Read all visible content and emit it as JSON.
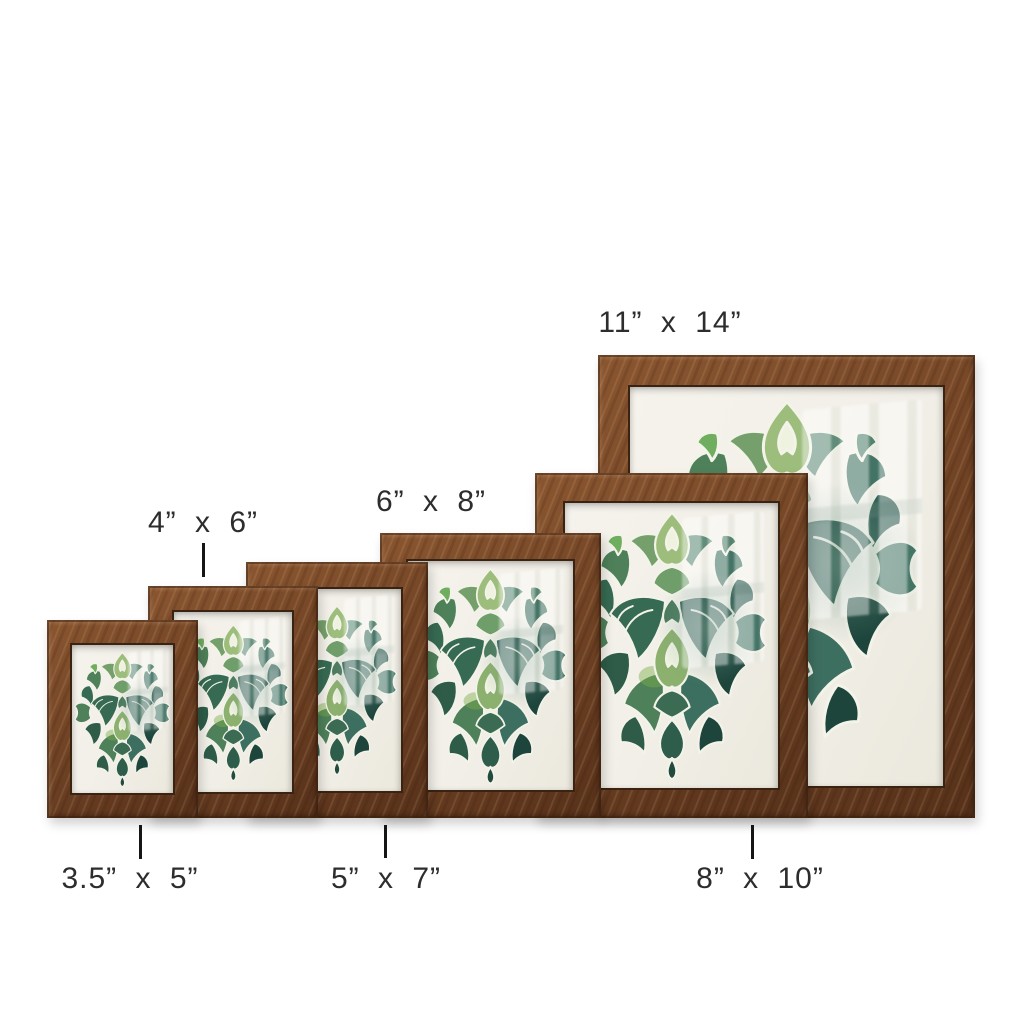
{
  "image_type": "picture frame size comparison",
  "frames": [
    {
      "id": "3.5x5",
      "label": "3.5” x 5”",
      "width_in": 3.5,
      "height_in": 5,
      "label_position": "below",
      "has_tick": true
    },
    {
      "id": "4x6",
      "label": "4” x 6”",
      "width_in": 4,
      "height_in": 6,
      "label_position": "above",
      "has_tick": true
    },
    {
      "id": "5x7",
      "label": "5” x 7”",
      "width_in": 5,
      "height_in": 7,
      "label_position": "below",
      "has_tick": true
    },
    {
      "id": "6x8",
      "label": "6” x 8”",
      "width_in": 6,
      "height_in": 8,
      "label_position": "above",
      "has_tick": false
    },
    {
      "id": "8x10",
      "label": "8” x 10”",
      "width_in": 8,
      "height_in": 10,
      "label_position": "below",
      "has_tick": true
    },
    {
      "id": "11x14",
      "label": "11” x 14”",
      "width_in": 11,
      "height_in": 14,
      "label_position": "above",
      "has_tick": false
    }
  ],
  "colors": {
    "background": "#ffffff",
    "frame_wood_light": "#8a5630",
    "frame_wood_dark": "#57311a",
    "matte_paper": "#f2f0e8",
    "label_text": "#2d2d2d",
    "tick": "#151515"
  },
  "art": {
    "description": "green watercolor damask ornament on white textured paper behind reflective glass",
    "palette": [
      "#9dbd7c",
      "#76a06b",
      "#6fae5e",
      "#4e8059",
      "#376a52",
      "#2e5c49",
      "#5c8a76",
      "#3d6f60",
      "#27554b",
      "#1d453c",
      "#7cae4a"
    ]
  }
}
